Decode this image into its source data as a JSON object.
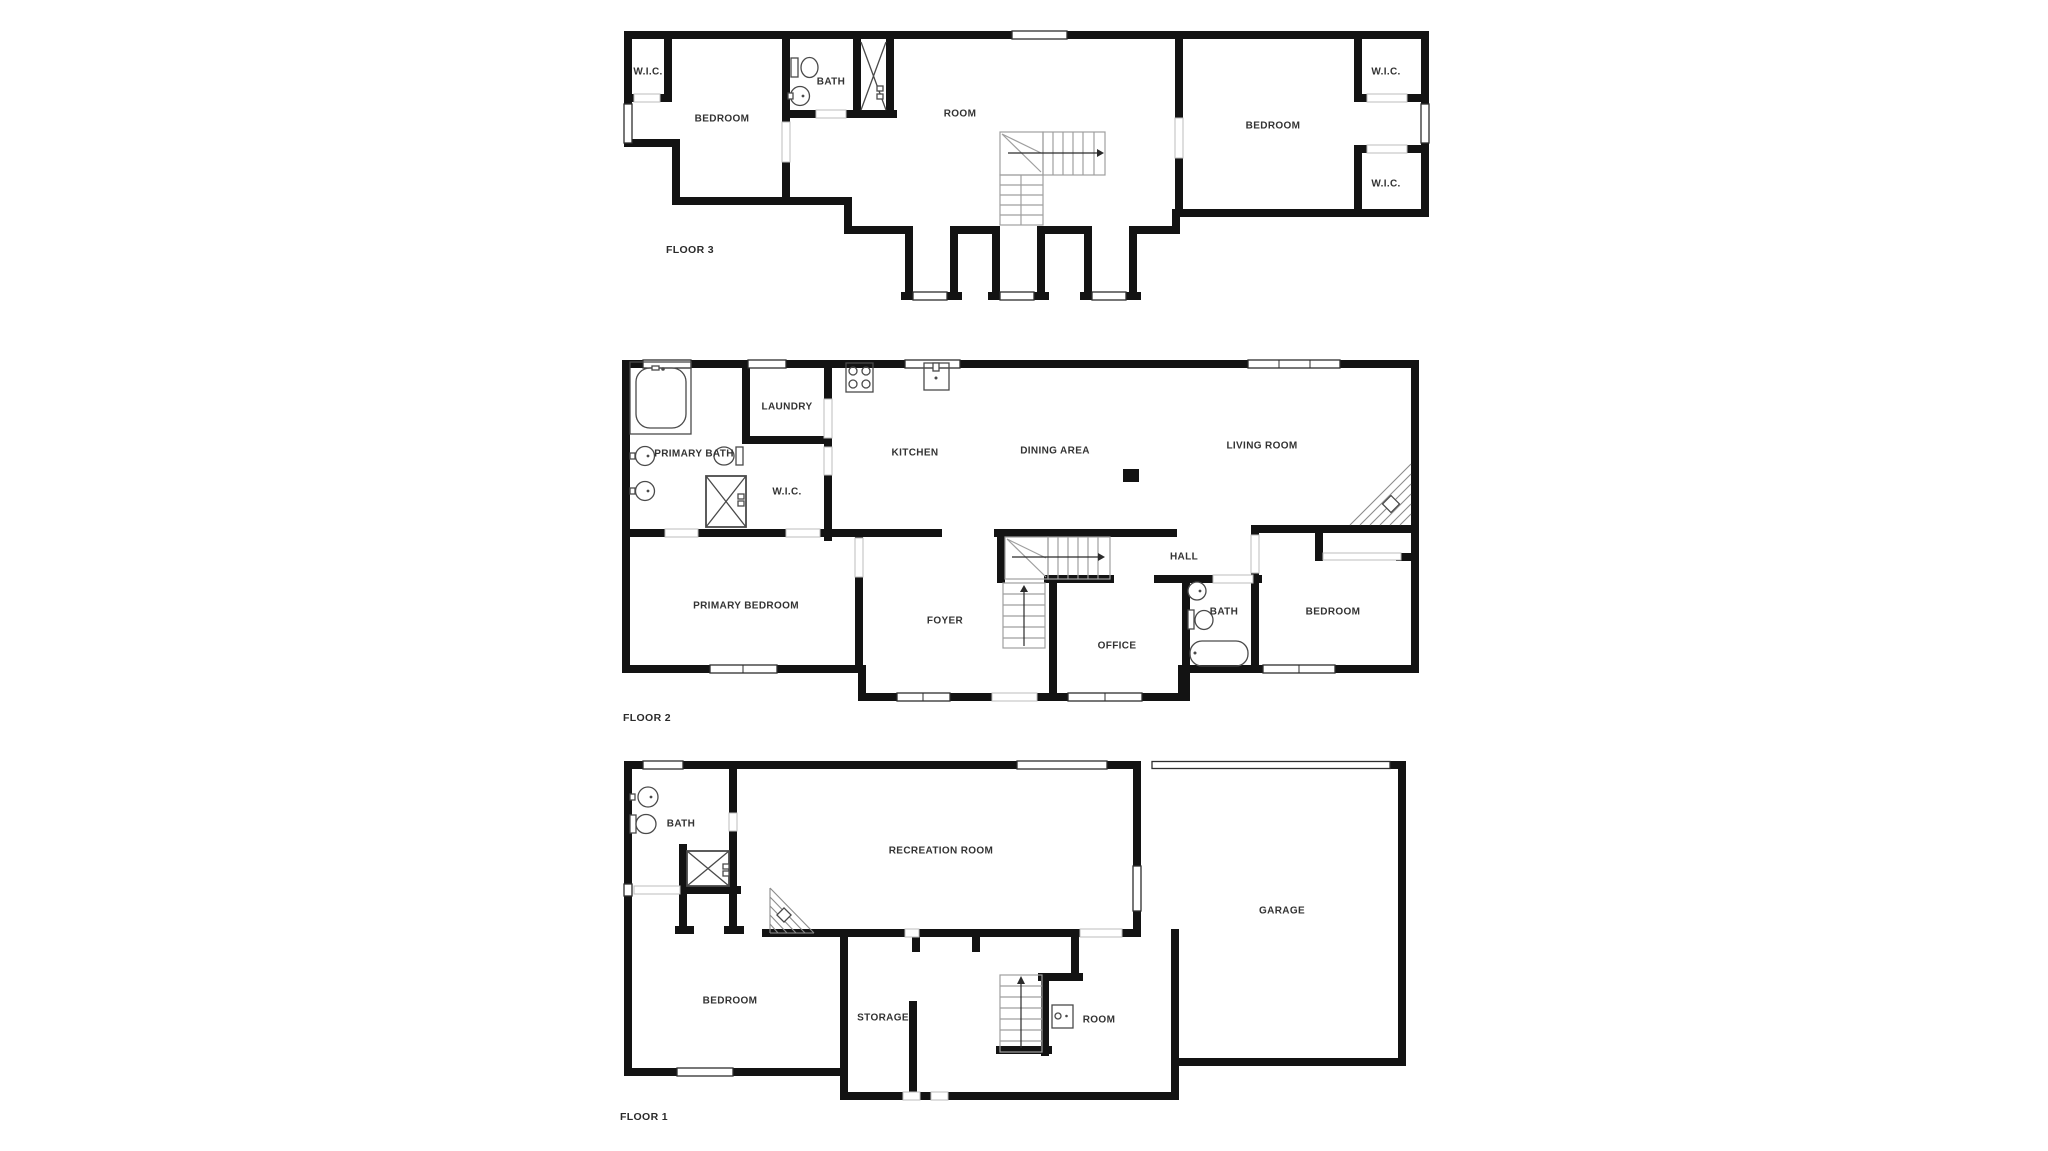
{
  "page": {
    "title": "Residential floor plan, three stacked floors",
    "background": "#ffffff"
  },
  "colors": {
    "wall": "#131313",
    "thin_line": "#2e2e2e",
    "door_line": "#bdbdbd",
    "stair_line": "#9f9f9f",
    "fixture_line": "#4a4a4a",
    "hatch_line": "#8c8c8c",
    "label": "#333333"
  },
  "floors": [
    {
      "title": "FLOOR 3",
      "rooms": [
        {
          "label": "W.I.C."
        },
        {
          "label": "BEDROOM"
        },
        {
          "label": "BATH"
        },
        {
          "label": "ROOM"
        },
        {
          "label": "BEDROOM"
        },
        {
          "label": "W.I.C."
        },
        {
          "label": "W.I.C."
        }
      ],
      "fixtures": [
        "toilet",
        "sink",
        "shower",
        "staircase",
        "window"
      ]
    },
    {
      "title": "FLOOR 2",
      "rooms": [
        {
          "label": "PRIMARY BATH"
        },
        {
          "label": "LAUNDRY"
        },
        {
          "label": "W.I.C."
        },
        {
          "label": "KITCHEN"
        },
        {
          "label": "DINING AREA"
        },
        {
          "label": "LIVING ROOM"
        },
        {
          "label": "PRIMARY BEDROOM"
        },
        {
          "label": "FOYER"
        },
        {
          "label": "HALL"
        },
        {
          "label": "OFFICE"
        },
        {
          "label": "BATH"
        },
        {
          "label": "BEDROOM"
        }
      ],
      "fixtures": [
        "bathtub",
        "sink",
        "toilet",
        "shower",
        "stove",
        "kitchen-sink",
        "corner-fireplace",
        "staircase",
        "closet",
        "window"
      ]
    },
    {
      "title": "FLOOR 1",
      "rooms": [
        {
          "label": "BATH"
        },
        {
          "label": "RECREATION ROOM"
        },
        {
          "label": "GARAGE"
        },
        {
          "label": "BEDROOM"
        },
        {
          "label": "STORAGE"
        },
        {
          "label": "ROOM"
        }
      ],
      "fixtures": [
        "sink",
        "toilet",
        "shower",
        "corner-fireplace",
        "staircase",
        "water-heater",
        "garage-door",
        "window"
      ]
    }
  ]
}
